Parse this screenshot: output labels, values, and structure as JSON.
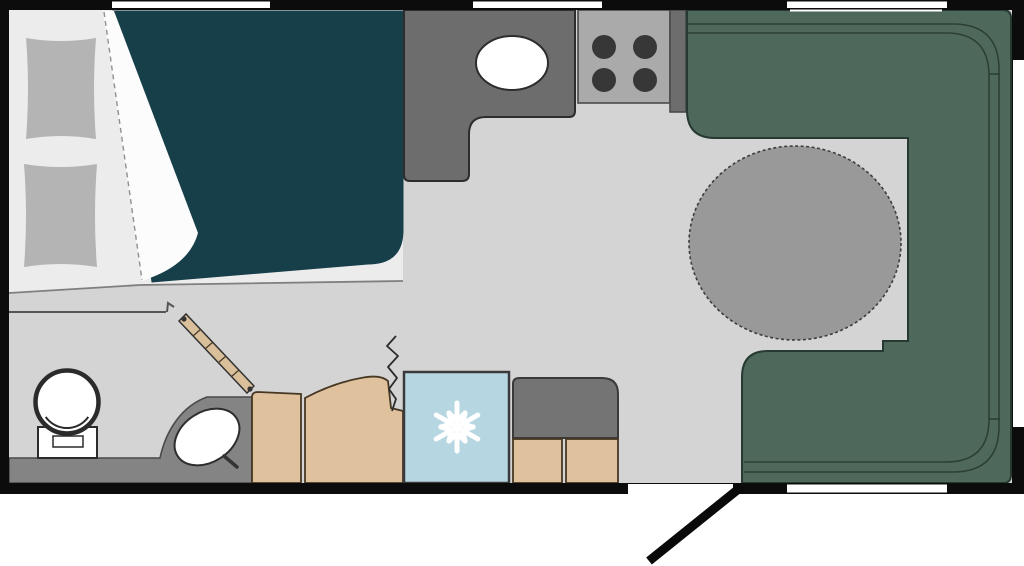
{
  "canvas": {
    "width": 1024,
    "height": 566
  },
  "colors": {
    "wall": "#0c0c0c",
    "floor": "#d4d4d4",
    "window": "#ffffff",
    "bed_base": "#ececec",
    "pillow": "#b4b4b4",
    "duvet": "#173f4a",
    "duvet_fold": "#fcfcfc",
    "counter": "#6d6d6d",
    "stove": "#aaaaaa",
    "burner": "#373737",
    "sink": "#ffffff",
    "bench": "#4e695b",
    "table": "#999999",
    "bath_counter": "#848484",
    "toilet": "#ffffff",
    "cabinet": "#dfc29d",
    "door_plank": "#d9c09b",
    "fridge": "#b6d7e2",
    "snowflake": "#ffffff",
    "overhead_cabinet": "#747474",
    "door_swing": "#0a0a0a"
  }
}
